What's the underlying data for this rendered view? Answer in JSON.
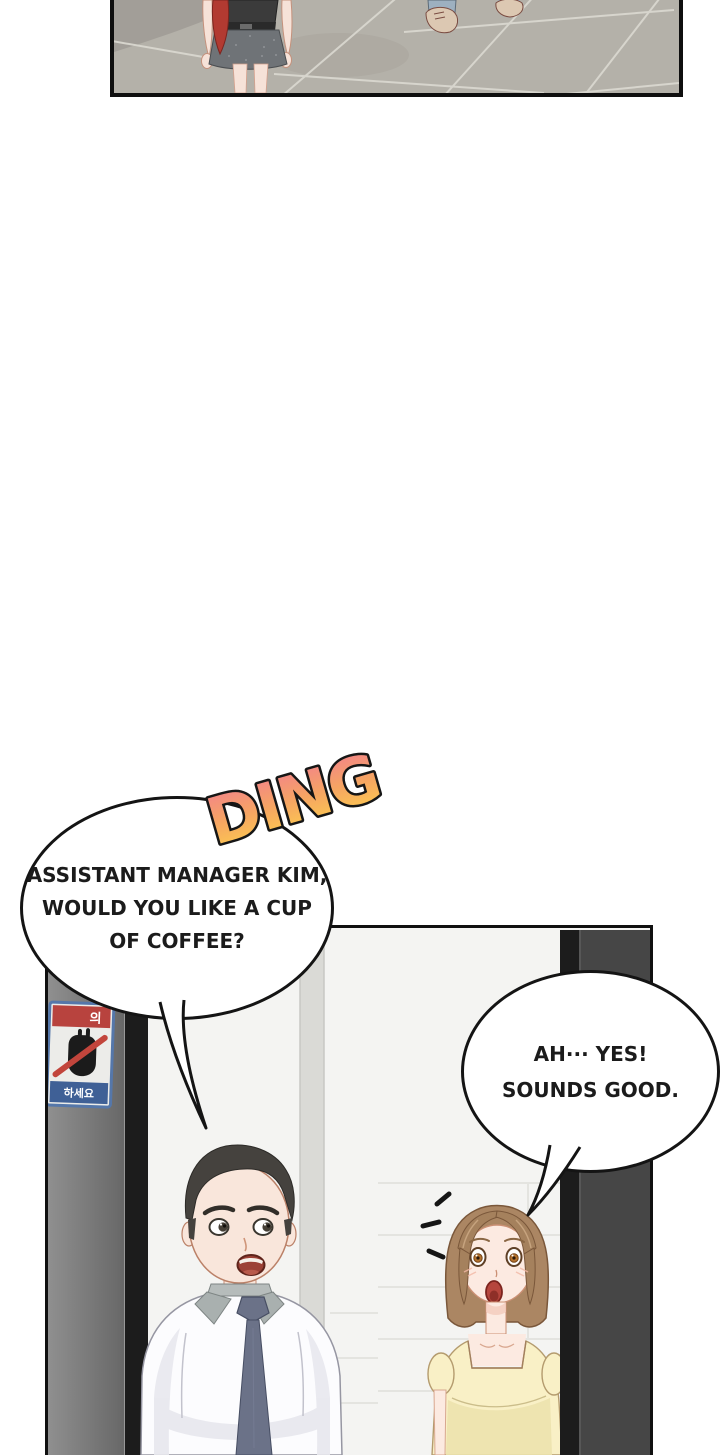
{
  "sfx": {
    "text": "DING",
    "gradient_top": "#f2808e",
    "gradient_mid": "#f6a562",
    "gradient_bottom": "#fdd04c",
    "outline_color": "#161616"
  },
  "bubble1": {
    "line1": "ASSISTANT MANAGER KIM,",
    "line2": "WOULD YOU LIKE A CUP",
    "line3": "OF COFFEE?"
  },
  "bubble2": {
    "line1": "AH··· YES!",
    "line2": "SOUNDS GOOD."
  },
  "elevator_sign": {
    "top_text": "의",
    "bottom_text": "하세요",
    "top_band_color": "#b8433e",
    "bottom_band_color": "#3f6096",
    "plate_color": "#ecece9",
    "border_color": "#5577aa"
  },
  "colors": {
    "floor": "#b4b1a9",
    "grout": "#d9d7cf",
    "interior_wall": "#f4f4f2",
    "left_door": "#8f8f8f",
    "right_door": "#464646",
    "door_dark_strip": "#1c1c1c",
    "man_hair": "#45423e",
    "man_tie": "#6b7288",
    "man_shirt": "#fcfcfe",
    "woman_hair": "#ab8663",
    "woman_bangs": "#a5815d",
    "woman_top": "#f9f0c6",
    "skin": "#f9e6db",
    "bubble_border": "#141414",
    "red_hair": "#b23a31",
    "jeans": "#9db0c0",
    "shoes": "#dcc8b2"
  }
}
